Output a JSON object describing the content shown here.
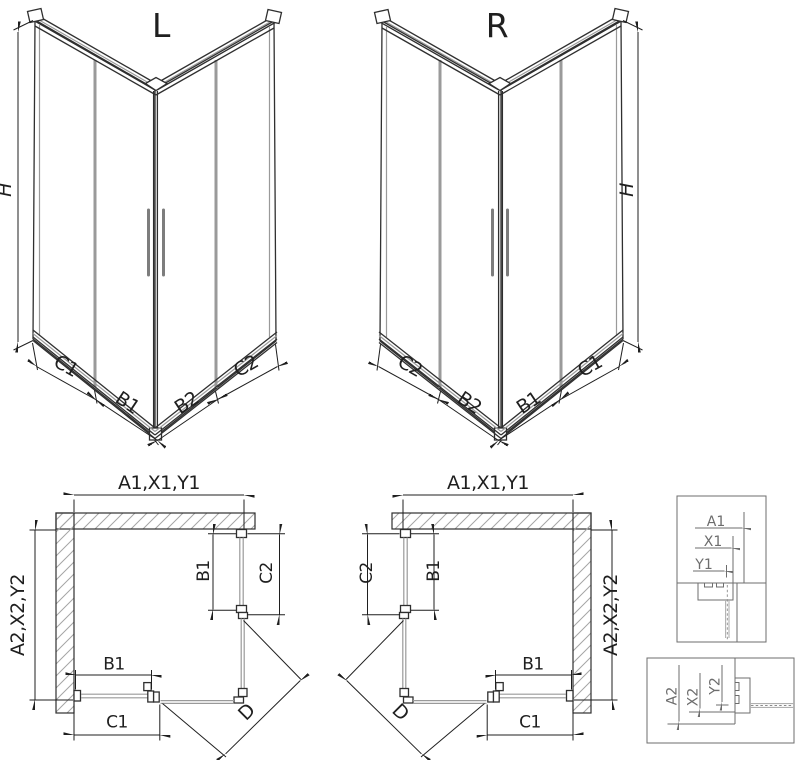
{
  "iso_l": {
    "title": "L",
    "h": "H",
    "c1": "C1",
    "b1": "B1",
    "b2": "B2",
    "c2": "C2"
  },
  "iso_r": {
    "title": "R",
    "h": "H",
    "c2": "C2",
    "b2": "B2",
    "b1": "B1",
    "c1": "C1"
  },
  "plan_l": {
    "width_top": "A1,X1,Y1",
    "depth_side": "A2,X2,Y2",
    "door_side": "B1",
    "panel_side": "C2",
    "door_bottom": "B1",
    "panel_bottom": "C1",
    "diagonal": "D"
  },
  "plan_r": {
    "width_top": "A1,X1,Y1",
    "depth_side": "A2,X2,Y2",
    "door_side": "B1",
    "panel_side": "C2",
    "door_bottom": "B1",
    "panel_bottom": "C1",
    "diagonal": "D"
  },
  "detail_top": {
    "a1": "A1",
    "x1": "X1",
    "y1": "Y1"
  },
  "detail_bottom": {
    "a2": "A2",
    "x2": "X2",
    "y2": "Y2"
  },
  "colors": {
    "background": "#ffffff",
    "line": "#2f2f2f",
    "dim": "#1f1f1f",
    "glass": "#9a9a9a",
    "detail": "#6d6d6d",
    "hatch": "#a5a5a5"
  }
}
